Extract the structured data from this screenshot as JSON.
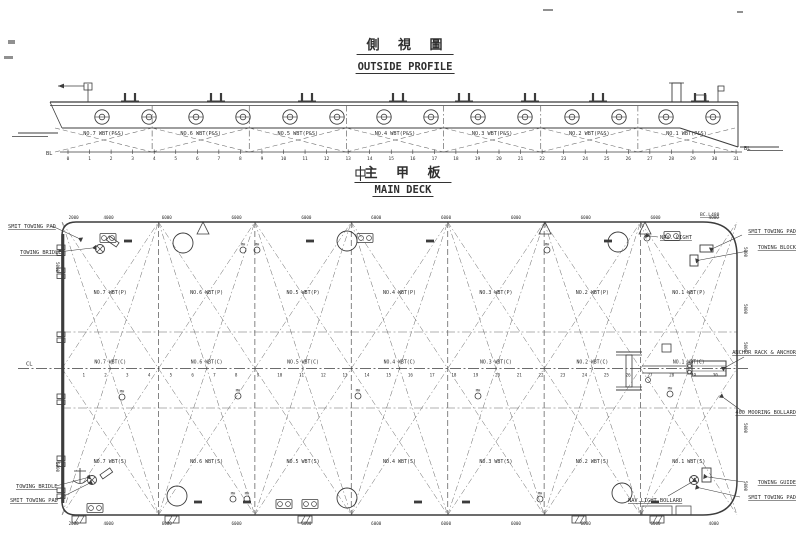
{
  "colors": {
    "ink": "#2f2f2f",
    "line": "#3c3c3c",
    "faint": "#676767",
    "paper": "#ffffff"
  },
  "profile": {
    "title_cn": "側 視 圖",
    "title_en": "OUTSIDE PROFILE",
    "bl_left": "BL",
    "bl_right": "BL",
    "frames": [
      "0",
      "1",
      "2",
      "3",
      "4",
      "5",
      "6",
      "7",
      "8",
      "9",
      "10",
      "11",
      "12",
      "13",
      "14",
      "15",
      "16",
      "17",
      "18",
      "19",
      "20",
      "21",
      "22",
      "23",
      "24",
      "25",
      "26",
      "27",
      "28",
      "29",
      "30",
      "31"
    ],
    "tanks": [
      "NO.7 WBT(P&S)",
      "NO.6 WBT(P&S)",
      "NO.5 WBT(P&S)",
      "NO.4 WBT(P&S)",
      "NO.3 WBT(P&S)",
      "NO.2 WBT(P&S)",
      "NO.1 WBT(P&S)"
    ]
  },
  "deck_header": {
    "title_cn": "主 甲 板",
    "title_en": "MAIN DECK"
  },
  "deck": {
    "cl_label": "CL",
    "bc_label": "BC.L480",
    "mh_label": "MH",
    "frames": [
      "1",
      "2",
      "3",
      "4",
      "5",
      "6",
      "7",
      "8",
      "9",
      "10",
      "11",
      "12",
      "13",
      "14",
      "15",
      "16",
      "17",
      "18",
      "19",
      "20",
      "21",
      "22",
      "23",
      "24",
      "25",
      "26",
      "27",
      "28",
      "29",
      "30"
    ],
    "tanks_p": [
      "NO.7 WBT(P)",
      "NO.6 WBT(P)",
      "NO.5 WBT(P)",
      "NO.4 WBT(P)",
      "NO.3 WBT(P)",
      "NO.2 WBT(P)",
      "NO.1 WBT(P)"
    ],
    "tanks_c": [
      "NO.7 WBT(C)",
      "NO.6 WBT(C)",
      "NO.5 WBT(C)",
      "NO.4 WBT(C)",
      "NO.3 WBT(C)",
      "NO.2 WBT(C)",
      "NO.1 WBT(C)"
    ],
    "tanks_s": [
      "NO.7 WBT(S)",
      "NO.6 WBT(S)",
      "NO.5 WBT(S)",
      "NO.4 WBT(S)",
      "NO.3 WBT(S)",
      "NO.2 WBT(S)",
      "NO.1 WBT(S)"
    ],
    "dims_top": [
      "2000",
      "4000",
      "6000",
      "6000",
      "6000",
      "6000",
      "6000",
      "6000",
      "6000",
      "6000",
      "4000"
    ],
    "dims_bottom": [
      "2000",
      "4000",
      "6000",
      "6000",
      "6000",
      "6000",
      "6000",
      "6000",
      "6000",
      "6000",
      "4000"
    ],
    "dims_right": [
      "5000",
      "5000",
      "5000",
      "5000",
      "5000"
    ],
    "dims_left": [
      "5000",
      "5000"
    ],
    "callouts": {
      "tl1": "SMIT TOWING PAD",
      "tl2": "TOWING BRIDLE",
      "tr1": "SMIT TOWING PAD",
      "tr2": "TOWING BLOCK",
      "tr_nav": "NAV. LIGHT",
      "r1": "ANCHOR RACK & ANCHOR",
      "r2": "400 MOORING BOLLARD",
      "br1": "TOWING GUIDE",
      "br2": "SMIT TOWING PAD",
      "br_nav": "NAV.LIGHT  BOLLARD",
      "bl1": "TOWING BRIDLE",
      "bl2": "SMIT TOWING PAD"
    }
  }
}
